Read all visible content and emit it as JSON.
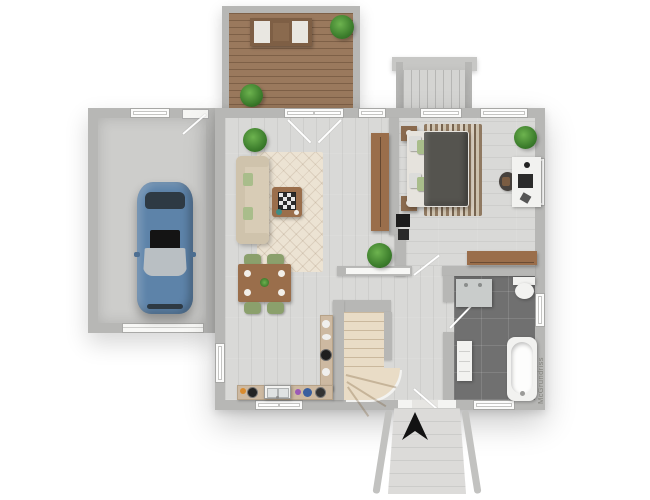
{
  "watermark": {
    "text": "McGrundriss"
  },
  "plan": {
    "rooms": [
      "deck",
      "garage",
      "living-room",
      "dining-area",
      "kitchen",
      "staircase",
      "hallway",
      "bedroom",
      "bathroom"
    ],
    "objects": [
      "car",
      "sofa",
      "coffee-table",
      "chessboard",
      "living-rug",
      "dining-table",
      "dining-chairs",
      "potted-plants",
      "wardrobe",
      "wall-tv",
      "double-bed",
      "nightstands",
      "bedroom-rug",
      "desk",
      "desk-chair",
      "dresser",
      "bathroom-vanity",
      "toilet",
      "radiator",
      "bathtub",
      "kitchen-counter",
      "kitchen-sink",
      "deck-bench",
      "entrance-arrow",
      "exterior-stairs",
      "entry-steps",
      "door-swings",
      "windows"
    ]
  },
  "colors": {
    "background": "#ffffff",
    "wall": "#b7b7b5",
    "wall_dark": "#a3a3a1",
    "floor_wood_light": "#d9d9d7",
    "garage_floor": "#cdcdcb",
    "deck_wood": "#9a795d",
    "bath_tile": "#707070",
    "stair_tread": "#e9dcc6",
    "ext_concrete": "#dcdbd9",
    "car_body": "#5d83a9",
    "car_glass": "#b9bfc3",
    "car_dark": "#2e3a44",
    "sofa": "#d8ccb6",
    "rug_cream": "#ece3d3",
    "wood_furniture": "#9a6e4b",
    "chair_green": "#8ba06c",
    "bed_duvet": "#55544f",
    "pillow_green": "#a9bd8b",
    "white_fixture": "#f2f2f0",
    "counter_tan": "#cdb9a1",
    "arrow_black": "#121212"
  }
}
